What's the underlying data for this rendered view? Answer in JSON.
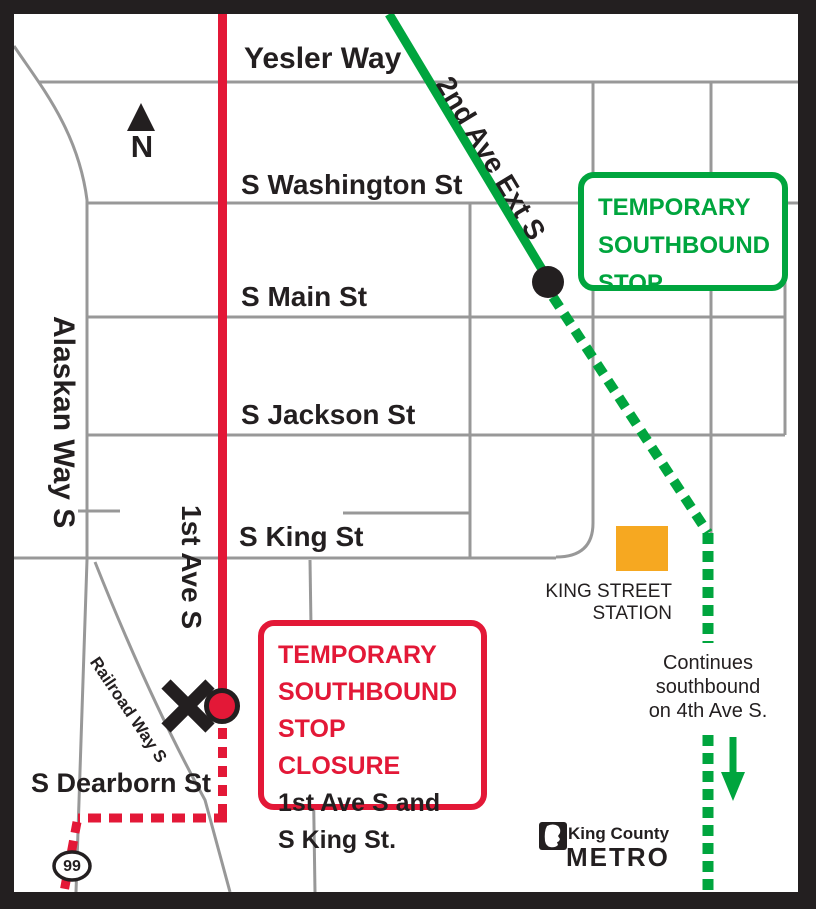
{
  "map": {
    "streets": {
      "yesler": "Yesler Way",
      "washington": "S Washington St",
      "main": "S Main St",
      "jackson": "S Jackson St",
      "king": "S King St",
      "dearborn": "S Dearborn St",
      "alaskan": "Alaskan Way S",
      "first_ave": "1st Ave S",
      "second_ave_ext": "2nd Ave Ext S",
      "railroad": "Railroad Way S"
    },
    "north_label": "N",
    "highway_shield": "99",
    "station": {
      "line1": "KING STREET",
      "line2": "STATION"
    },
    "green_callout": {
      "line1": "TEMPORARY",
      "line2": "SOUTHBOUND",
      "line3": "STOP"
    },
    "red_callout": {
      "warn1": "TEMPORARY",
      "warn2": "SOUTHBOUND",
      "warn3": "STOP CLOSURE",
      "loc1": "1st Ave S and",
      "loc2": "S King St."
    },
    "continues_note": {
      "line1": "Continues",
      "line2": "southbound",
      "line3": "on 4th Ave S."
    },
    "logo": {
      "agency": "King County",
      "brand": "METRO"
    },
    "colors": {
      "route_green": "#00A53E",
      "route_red": "#E31837",
      "station_orange": "#F6A821",
      "road_gray": "#989898",
      "ink": "#231F20"
    }
  }
}
